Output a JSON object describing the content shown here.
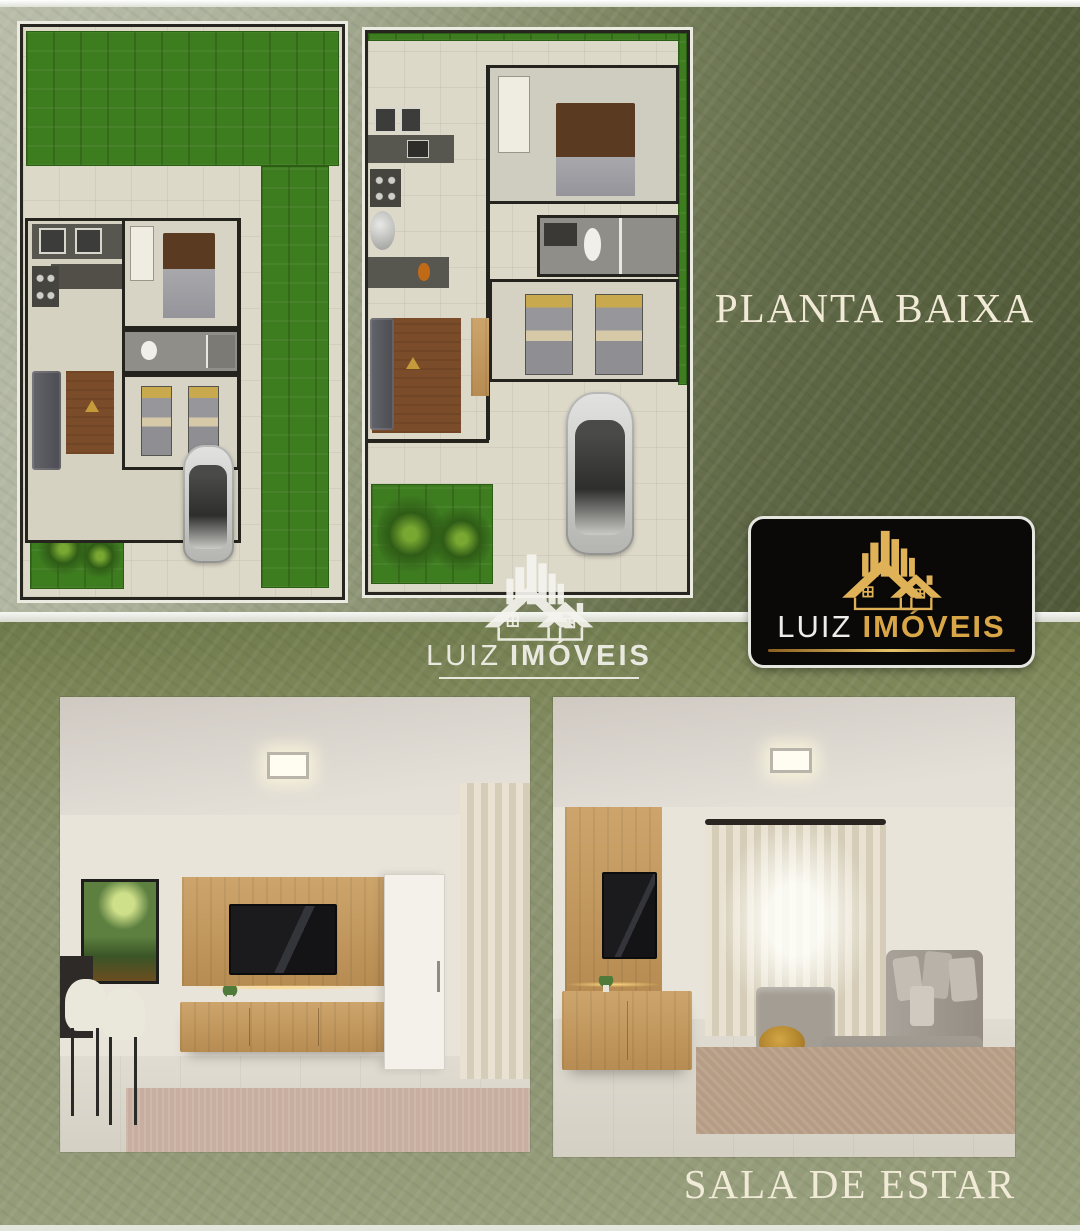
{
  "top_section": {
    "title": "PLANTA BAIXA",
    "plans": [
      {
        "label": "site-plan-with-garden-and-car"
      },
      {
        "label": "floor-plan-detail-two-bedrooms"
      }
    ]
  },
  "bottom_section": {
    "title": "SALA DE ESTAR",
    "renders": [
      {
        "label": "living-room-tv-panel-and-bar-stools"
      },
      {
        "label": "living-room-gray-sectional-sofa"
      }
    ]
  },
  "brand": {
    "word1": "LUIZ",
    "word2": "IMÓVEIS"
  },
  "icons": {
    "logo_mark": "buildings-house-icon"
  },
  "colors": {
    "top_bg_light": "#b9bdaa",
    "top_bg_dark": "#505a39",
    "bottom_bg": "#8b9370",
    "divider_band": "#f6f7f3",
    "title_text": "#f0ead6",
    "badge_bg": "#0a0908",
    "badge_border": "#e6e6e1",
    "gold": "#d8a647",
    "grass_green": "#3e7c20",
    "plan_floor": "#ddd9c9",
    "wall_dark": "#24231d"
  }
}
